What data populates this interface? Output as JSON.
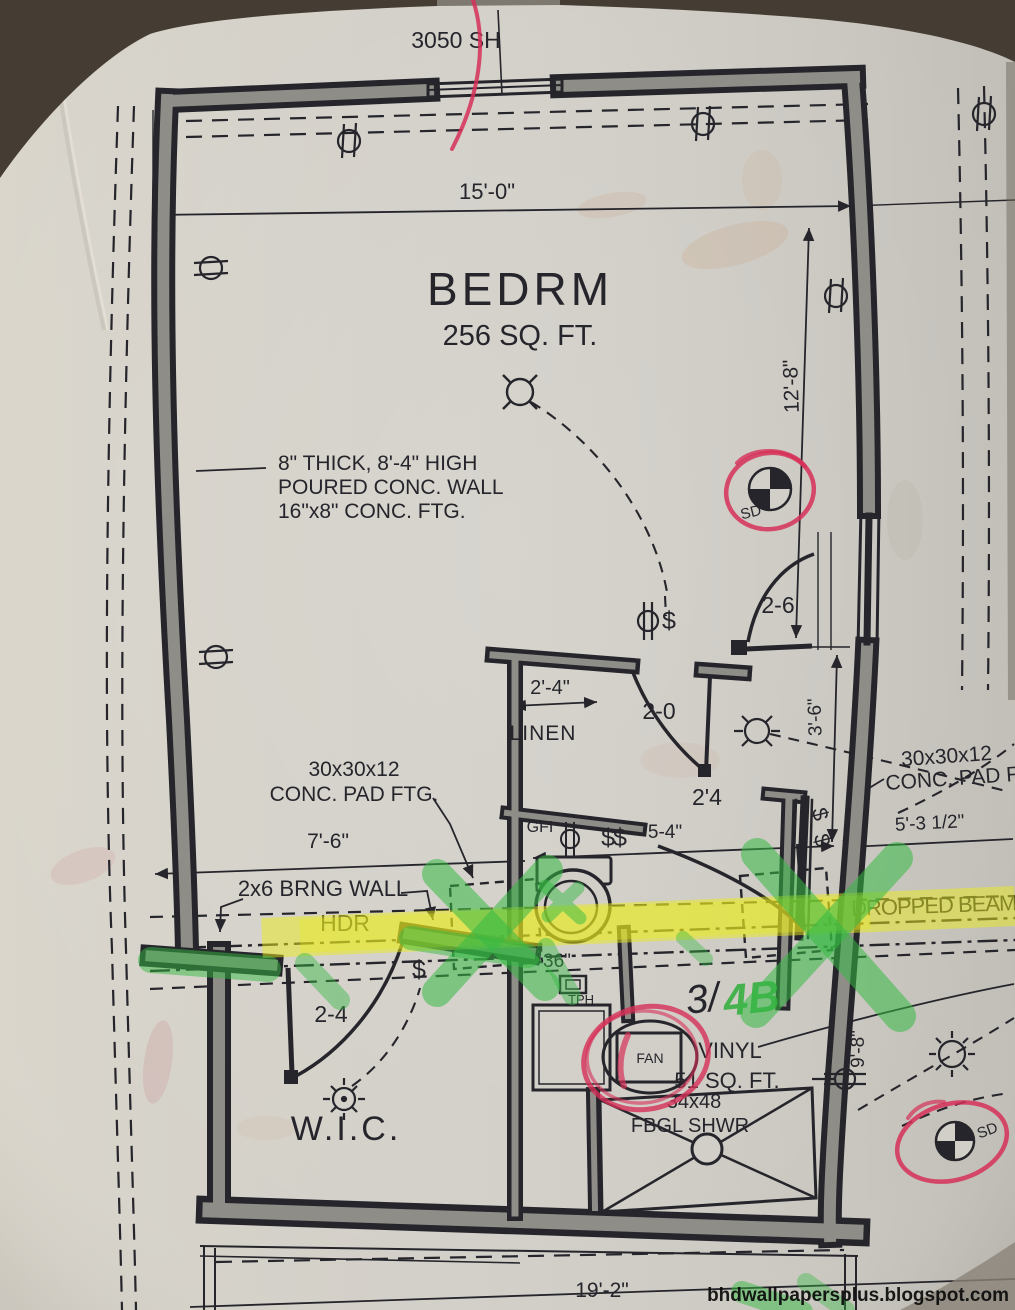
{
  "colors": {
    "paper": "#d2cfc8",
    "ink": "#25252b",
    "wall": "#8e8d87",
    "yellow": "#e9ec1e",
    "green": "#35b944",
    "red": "#d63058"
  },
  "rooms": {
    "bedroom": {
      "name": "BEDRM",
      "area": "256 SQ. FT."
    },
    "bath": {
      "floor": "VINYL",
      "area": "51 SQ. FT."
    },
    "closet": {
      "name": "W.I.C."
    },
    "linen": {
      "name": "LINEN"
    }
  },
  "labels": {
    "window_size": "3050 SH",
    "wall_note1": "8\" THICK, 8'-4\" HIGH",
    "wall_note2": "POURED CONC. WALL",
    "wall_note3": "16\"x8\" CONC. FTG.",
    "pad_note1": "30x30x12",
    "pad_note2": "CONC. PAD FTG.",
    "bearing_wall": "2x6 BRNG WALL",
    "header": "HDR",
    "dropped_beam": "DROPPED BEAM",
    "gfi": "GFI",
    "tph": "TPH",
    "fan": "FAN",
    "smoke_detector": "SD",
    "shower1": "34x48",
    "shower2": "FBGL SHWR",
    "hand_note_black": "3/",
    "hand_note_green": "4B",
    "switch": "$",
    "switch_double": "$$"
  },
  "dimensions": {
    "width_top": "15'-0\"",
    "right_upper": "12'-8\"",
    "linen_width": "2'-4\"",
    "hall_depth": "3'-6\"",
    "left_span": "7'-6\"",
    "bath_width": "5-4\"",
    "right_offset": "5'-3 1/2\"",
    "bath_height": "9'-8\"",
    "bottom_width": "19'-2\"",
    "toilet_clear": "36\"",
    "door_bedroom": "2-6",
    "door_linen": "2-0",
    "door_bath": "2'4",
    "door_wic": "2-4"
  },
  "watermark": "bhdwallpapersplus.blogspot.com"
}
